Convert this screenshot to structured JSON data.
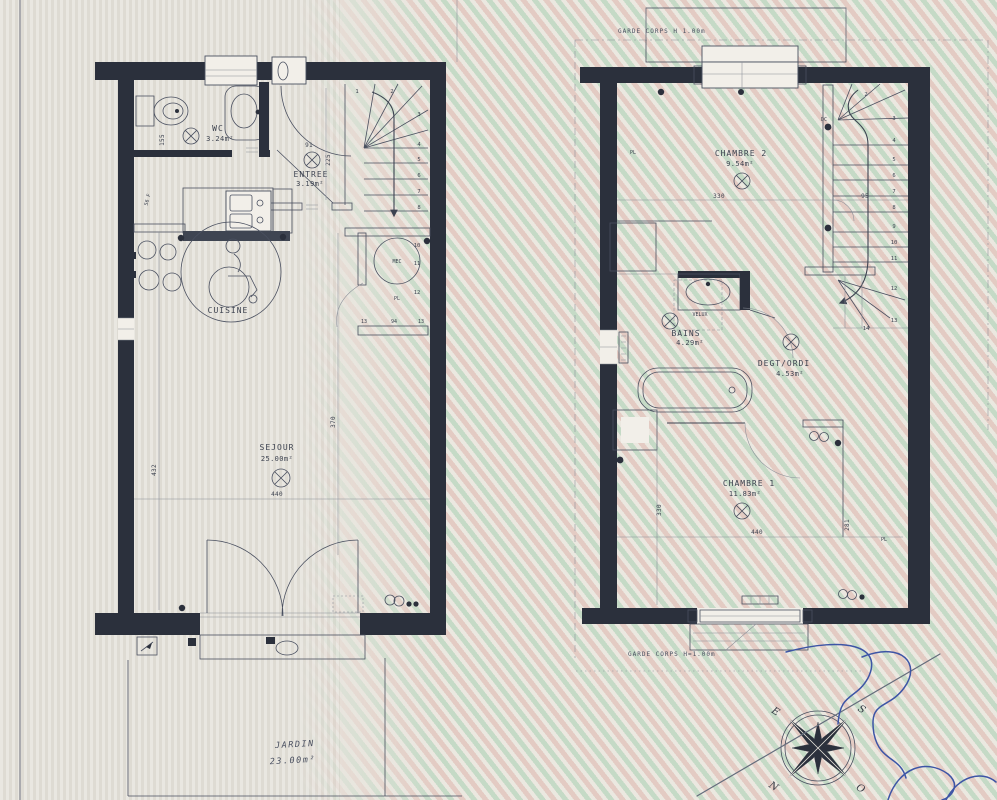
{
  "palette": {
    "wall": "#2b303c",
    "line": "#4a5060",
    "text": "#3d4350",
    "blue_pen": "#3d55a6",
    "moire_pink": "#deA89e",
    "moire_green": "#94cba6",
    "paper": "#e7e4dd"
  },
  "ground_floor": {
    "wc": {
      "name": "WC",
      "area": "3.24m²"
    },
    "entree": {
      "name": "ENTREE",
      "area": "3.19m²"
    },
    "cuisine": {
      "name": "CUISINE"
    },
    "sejour": {
      "name": "SEJOUR",
      "area": "25.00m²"
    },
    "mec_label": "MEC",
    "pl_label": "PL",
    "stairs": [
      "1",
      "2",
      "3",
      "4",
      "5",
      "6",
      "7",
      "8",
      "10",
      "11",
      "12"
    ],
    "dims": {
      "d440": "440",
      "d432": "432",
      "d370": "370",
      "d225": "225",
      "d91": "91",
      "d155": "155",
      "d56": "56 F",
      "d13a": "13",
      "d94": "94",
      "d13b": "13"
    }
  },
  "exterior": {
    "jardin": {
      "name": "JARDIN",
      "area": "23.00m²"
    }
  },
  "upper_floor": {
    "garde_corps_top": "GARDE CORPS H 1.00m",
    "garde_corps_bottom": "GARDE CORPS H=1.00m",
    "chambre2": {
      "name": "CHAMBRE 2",
      "area": "9.54m²"
    },
    "bains": {
      "name": "BAINS",
      "area": "4.29m²"
    },
    "velux_label": "VELUX",
    "degt": {
      "name": "DEGT/ORDI",
      "area": "4.53m²"
    },
    "chambre1": {
      "name": "CHAMBRE 1",
      "area": "11.83m²"
    },
    "pl_left": "PL",
    "pl_right": "PL",
    "dc_label": "DC",
    "stairs": [
      "2",
      "3",
      "4",
      "5",
      "6",
      "7",
      "8",
      "9",
      "10",
      "11",
      "12",
      "13",
      "14"
    ],
    "dims": {
      "d330": "330",
      "d95": "95",
      "d440": "440",
      "d330v": "330",
      "d281": "281"
    }
  },
  "compass": {
    "e": "E",
    "s": "S",
    "n": "N",
    "o": "O"
  }
}
